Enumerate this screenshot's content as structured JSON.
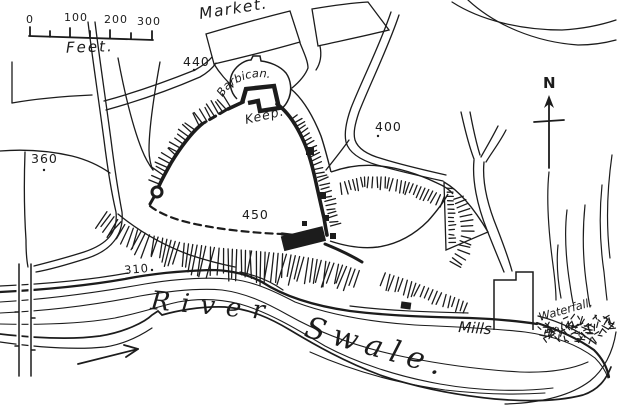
{
  "map": {
    "scale_bar": {
      "ticks": [
        "0",
        "100",
        "200",
        "300"
      ],
      "unit": "Feet."
    },
    "labels": {
      "market": "Market.",
      "barbican": "Barbican.",
      "keep": "Keep.",
      "hall": "Hall.",
      "mills": "Mills",
      "waterfall": "Waterfall.",
      "river_word1": "River",
      "river_word2": "Swale.",
      "north": "N"
    },
    "spot_heights": {
      "h440": "440",
      "h400": "400",
      "h360": "360",
      "h450": "450",
      "h310": "310"
    },
    "colors": {
      "ink": "#1c1c1c",
      "paper": "#ffffff"
    }
  }
}
